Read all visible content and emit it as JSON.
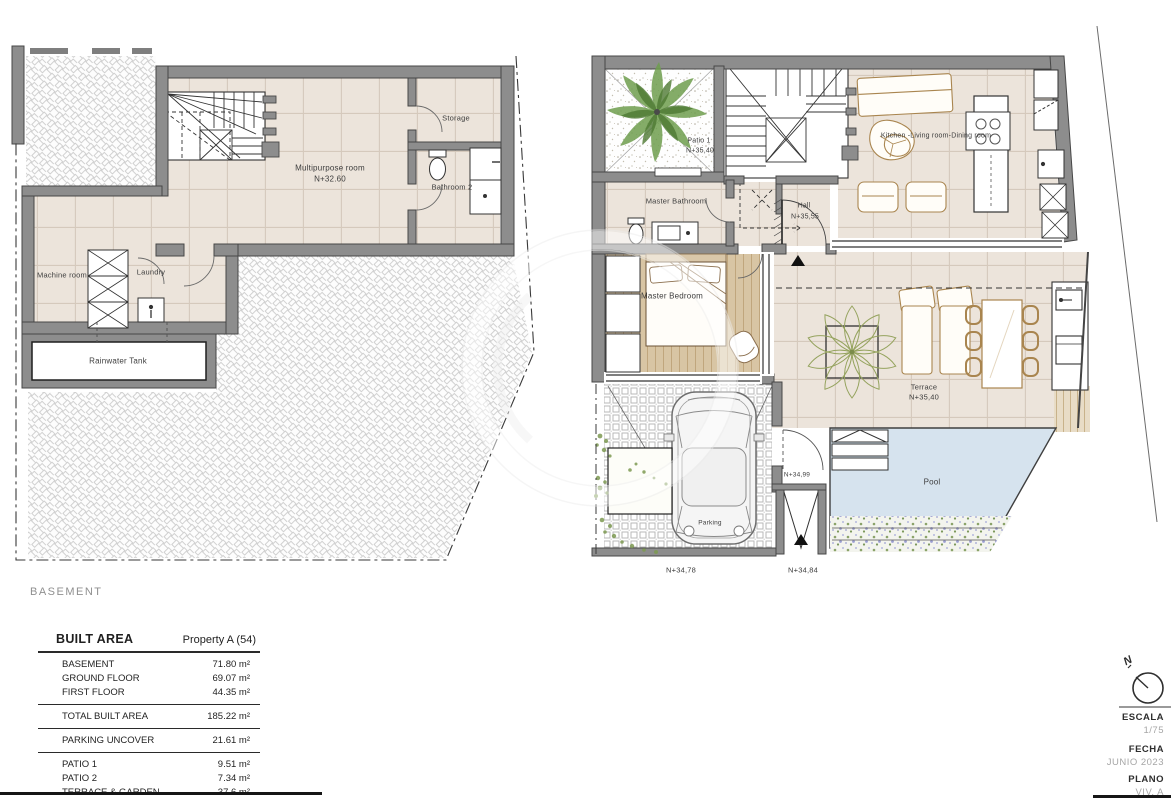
{
  "basement_plan": {
    "caption": "BASEMENT",
    "rooms": {
      "multipurpose_name": "Multipurpose room",
      "multipurpose_level": "N+32.60",
      "storage": "Storage",
      "bathroom2": "Bathroom 2",
      "machine_room": "Machine room",
      "laundry": "Laundry",
      "rainwater_tank": "Rainwater Tank"
    }
  },
  "ground_plan": {
    "rooms": {
      "patio1_name": "Patio 1",
      "patio1_level": "N+35,40",
      "master_bathroom": "Master Bathroom",
      "master_bedroom": "Master Bedroom",
      "hall_name": "Hall",
      "hall_level": "N+35,55",
      "kitchen_living_dining": "Kitchen -Living room-Dining room",
      "terrace_name": "Terrace",
      "terrace_level": "N+35,40",
      "parking": "Parking",
      "pool": "Pool"
    },
    "levels": {
      "parking_street": "N+34,78",
      "gate_street": "N+34,84",
      "entrance_gate": "N+34,99"
    }
  },
  "area_table": {
    "title": "BUILT AREA",
    "property": "Property  A (54)",
    "floors": [
      {
        "label": "BASEMENT",
        "value": "71.80 m²"
      },
      {
        "label": "GROUND FLOOR",
        "value": "69.07 m²"
      },
      {
        "label": "FIRST FLOOR",
        "value": "44.35 m²"
      }
    ],
    "total": {
      "label": "TOTAL BUILT AREA",
      "value": "185.22 m²"
    },
    "parking": {
      "label": "PARKING UNCOVER",
      "value": "21.61 m²"
    },
    "outdoor": [
      {
        "label": "PATIO 1",
        "value": "9.51 m²"
      },
      {
        "label": "PATIO 2",
        "value": "7.34 m²"
      },
      {
        "label": "TERRACE & GARDEN",
        "value": "37.6 m²"
      },
      {
        "label": "POOL",
        "value": "13.56 m²"
      }
    ]
  },
  "title_block": {
    "north_label": "N",
    "escala_label": "ESCALA",
    "escala_value": "1/75",
    "fecha_label": "FECHA",
    "fecha_value": "JUNIO 2023",
    "plano_label": "PLANO",
    "plano_value": "VIV. A"
  },
  "colors": {
    "wall": "#8d8d8d",
    "floor_tile": "#ece4db",
    "wood": "#d8c5a4",
    "pool": "#d6e3ee",
    "plant": "#6f9e4f"
  }
}
